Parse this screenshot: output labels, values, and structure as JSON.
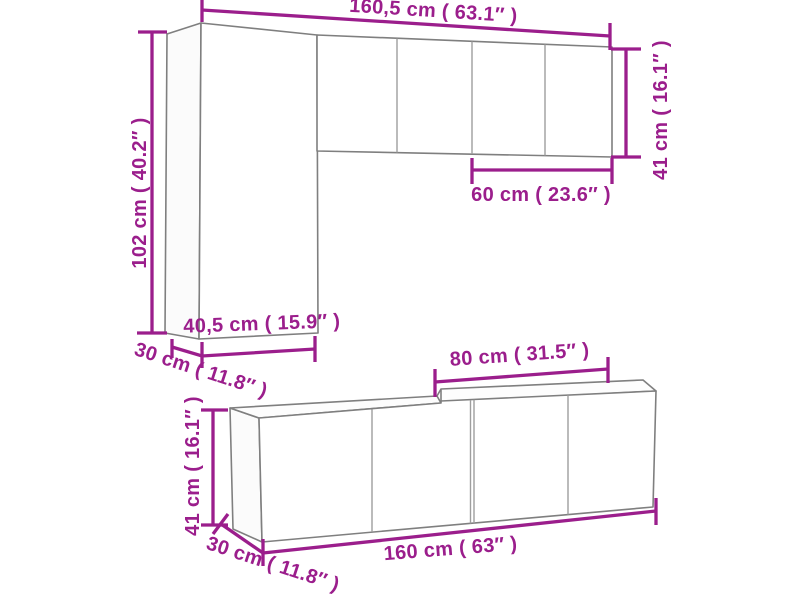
{
  "colors": {
    "accent": "#9b1e8c",
    "outline": "#7f7f7f",
    "inner_line": "#9e9e9e",
    "background": "#ffffff"
  },
  "diagram": {
    "upper_assembly": {
      "total_width_label": "160,5 cm ( 63.1″ )",
      "tall_cabinet_height_label": "102 cm ( 40.2″ )",
      "wall_cabinet_height_label": "41 cm ( 16.1″ )",
      "wall_cabinet_width_label": "60 cm ( 23.6″ )",
      "tall_cabinet_width_label": "40,5 cm ( 15.9″ )",
      "tall_cabinet_depth_label": "30 cm ( 11.8″ )"
    },
    "lower_assembly": {
      "cabinet_width_label": "80 cm ( 31.5″ )",
      "height_label": "41 cm ( 16.1″ )",
      "total_width_label": "160 cm ( 63″ )",
      "depth_label": "30 cm ( 11.8″ )"
    }
  }
}
